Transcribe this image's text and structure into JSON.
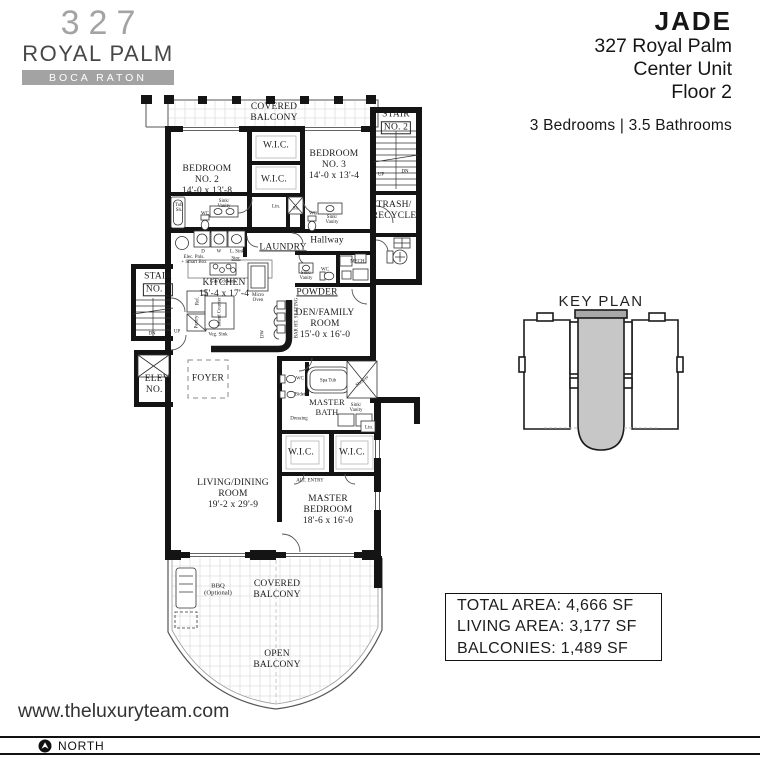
{
  "brand": {
    "number": "327",
    "name": "ROYAL PALM",
    "city": "BOCA RATON"
  },
  "title": {
    "building": "JADE",
    "address": "327 Royal Palm",
    "unit": "Center Unit",
    "floor": "Floor 2",
    "specs": "3 Bedrooms | 3.5 Bathrooms"
  },
  "key_plan": {
    "title": "KEY PLAN"
  },
  "areas": {
    "total": "TOTAL AREA: 4,666 SF",
    "living": "LIVING AREA: 3,177 SF",
    "balconies": "BALCONIES: 1,489 SF"
  },
  "footer": {
    "website": "www.theluxuryteam.com",
    "north": "NORTH"
  },
  "plan": {
    "rooms": {
      "covered_balcony": "COVERED\nBALCONY",
      "open_balcony": "OPEN\nBALCONY",
      "bedroom2": "BEDROOM\nNO. 2\n14'-0 x 13'-8",
      "bedroom3": "BEDROOM\nNO. 3\n14'-0 x 13'-4",
      "wic": "W.I.C.",
      "lin": "Lin.",
      "stair_label": "STAIR",
      "stair2_no": "NO. 2",
      "stair3_no": "NO. 3",
      "trash": "TRASH/\nRECYCLE",
      "laundry": "LAUNDRY",
      "hallway": "Hallway",
      "mech": "MECH.",
      "powder": "POWDER",
      "kitchen": "KITCHEN\n15'-4 x 17'-4",
      "den": "DEN/FAMILY\nROOM\n15'-0 x 16'-0",
      "elev2": "ELEV.\nNO. 2",
      "foyer": "FOYER",
      "master_bath": "MASTER\nBATH",
      "alt_entry": "ALT. ENTRY",
      "living": "LIVING/DINING\nROOM\n19'-2 x 29'-9",
      "master_bedroom": "MASTER\nBEDROOM\n18'-6 x 16'-0",
      "bbq": "BBQ\n(Optional)"
    },
    "fixtures": {
      "tub_sh": "Tub\nSh.",
      "wc": "WC",
      "sink_vanity": "Sink/\nVanity",
      "d": "D",
      "w": "W",
      "l_sink": "L. Sink",
      "stor": "Stor.",
      "elec": "Elec. Pnls.\n+ Smart Box",
      "sh": "Sh.",
      "gas_cooktop": "Gas Cooktop",
      "micro": "Micro\nOven",
      "ref": "Ref.",
      "pantry": "Pantry",
      "island": "Island Counter",
      "veg_sink": "Veg. Sink",
      "dw": "DW",
      "bar_seating": "BAR HT. SEATING",
      "bidet": "Bidet",
      "spa_tub": "Spa Tub",
      "shower": "Shower",
      "dressing": "Dressing",
      "up": "UP",
      "dn": "DN"
    }
  }
}
